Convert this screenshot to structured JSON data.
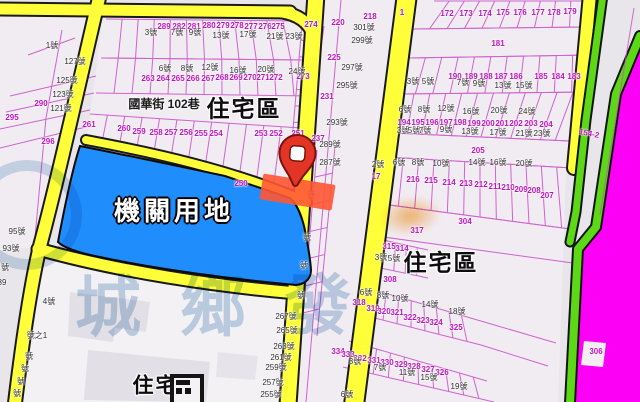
{
  "map": {
    "colors": {
      "road_yellow": "#ffff3a",
      "institution_blue": "#1f8dfc",
      "zone_strip_magenta": "#fb00f4",
      "greenbelt": "#5cd816",
      "selection_highlight": "#ff5634",
      "parcel_line": "#c84cc8",
      "parcel_number": "#c013c0",
      "house_number": "#2e2e2e"
    },
    "zone_labels": [
      {
        "t": "住宅區",
        "x": 244,
        "y": 109,
        "s": 23,
        "st": "k"
      },
      {
        "t": "住宅區",
        "x": 441,
        "y": 263,
        "s": 23,
        "st": "k"
      },
      {
        "t": "住宅區",
        "x": 167,
        "y": 386,
        "s": 21,
        "st": "k"
      },
      {
        "t": "機關用地",
        "x": 174,
        "y": 211,
        "s": 26,
        "st": "w"
      }
    ],
    "street_label": {
      "text": "國華街 102巷",
      "x": 164,
      "y": 104
    },
    "watermark": {
      "chars": [
        {
          "c": "城",
          "x": 108,
          "y": 302
        },
        {
          "c": "鄉",
          "x": 213,
          "y": 302
        },
        {
          "c": "發",
          "x": 318,
          "y": 300
        }
      ]
    },
    "pin": {
      "x": 297,
      "y": 163
    },
    "parcel_numbers": [
      {
        "t": "290",
        "x": 41,
        "y": 104
      },
      {
        "t": "296",
        "x": 48,
        "y": 142
      },
      {
        "t": "295",
        "x": 12,
        "y": 118
      },
      {
        "t": "289",
        "x": 164,
        "y": 27
      },
      {
        "t": "282",
        "x": 179,
        "y": 27
      },
      {
        "t": "281",
        "x": 194,
        "y": 27
      },
      {
        "t": "280",
        "x": 209,
        "y": 26
      },
      {
        "t": "279",
        "x": 223,
        "y": 26
      },
      {
        "t": "278",
        "x": 237,
        "y": 26
      },
      {
        "t": "277",
        "x": 251,
        "y": 27
      },
      {
        "t": "276",
        "x": 265,
        "y": 27
      },
      {
        "t": "275",
        "x": 278,
        "y": 27
      },
      {
        "t": "274",
        "x": 311,
        "y": 25
      },
      {
        "t": "220",
        "x": 338,
        "y": 23
      },
      {
        "t": "218",
        "x": 370,
        "y": 17
      },
      {
        "t": "225",
        "x": 334,
        "y": 58
      },
      {
        "t": "231",
        "x": 327,
        "y": 97
      },
      {
        "t": "237",
        "x": 318,
        "y": 139
      },
      {
        "t": "263",
        "x": 148,
        "y": 79
      },
      {
        "t": "264",
        "x": 163,
        "y": 79
      },
      {
        "t": "265",
        "x": 178,
        "y": 79
      },
      {
        "t": "266",
        "x": 193,
        "y": 79
      },
      {
        "t": "267",
        "x": 208,
        "y": 79
      },
      {
        "t": "268",
        "x": 222,
        "y": 78
      },
      {
        "t": "269",
        "x": 236,
        "y": 78
      },
      {
        "t": "270",
        "x": 250,
        "y": 78
      },
      {
        "t": "271",
        "x": 263,
        "y": 78
      },
      {
        "t": "272",
        "x": 276,
        "y": 78
      },
      {
        "t": "273",
        "x": 303,
        "y": 77
      },
      {
        "t": "261",
        "x": 89,
        "y": 125
      },
      {
        "t": "260",
        "x": 124,
        "y": 129
      },
      {
        "t": "259",
        "x": 139,
        "y": 132
      },
      {
        "t": "258",
        "x": 156,
        "y": 133
      },
      {
        "t": "257",
        "x": 171,
        "y": 133
      },
      {
        "t": "256",
        "x": 186,
        "y": 133
      },
      {
        "t": "255",
        "x": 201,
        "y": 134
      },
      {
        "t": "254",
        "x": 216,
        "y": 134
      },
      {
        "t": "253",
        "x": 261,
        "y": 134
      },
      {
        "t": "252",
        "x": 276,
        "y": 134
      },
      {
        "t": "251",
        "x": 298,
        "y": 134
      },
      {
        "t": "250",
        "x": 241,
        "y": 184
      },
      {
        "t": "1",
        "x": 402,
        "y": 13
      },
      {
        "t": "172",
        "x": 447,
        "y": 14
      },
      {
        "t": "173",
        "x": 466,
        "y": 14
      },
      {
        "t": "174",
        "x": 485,
        "y": 14
      },
      {
        "t": "175",
        "x": 503,
        "y": 13
      },
      {
        "t": "176",
        "x": 520,
        "y": 13
      },
      {
        "t": "177",
        "x": 538,
        "y": 13
      },
      {
        "t": "178",
        "x": 554,
        "y": 13
      },
      {
        "t": "179",
        "x": 570,
        "y": 12
      },
      {
        "t": "181",
        "x": 498,
        "y": 44
      },
      {
        "t": "190",
        "x": 455,
        "y": 77
      },
      {
        "t": "189",
        "x": 471,
        "y": 77
      },
      {
        "t": "188",
        "x": 486,
        "y": 77
      },
      {
        "t": "187",
        "x": 501,
        "y": 77
      },
      {
        "t": "186",
        "x": 516,
        "y": 77
      },
      {
        "t": "185",
        "x": 541,
        "y": 77
      },
      {
        "t": "184",
        "x": 558,
        "y": 77
      },
      {
        "t": "183",
        "x": 574,
        "y": 77
      },
      {
        "t": "194",
        "x": 404,
        "y": 123
      },
      {
        "t": "195",
        "x": 418,
        "y": 123
      },
      {
        "t": "196",
        "x": 432,
        "y": 123
      },
      {
        "t": "197",
        "x": 446,
        "y": 123
      },
      {
        "t": "198",
        "x": 460,
        "y": 123
      },
      {
        "t": "199",
        "x": 474,
        "y": 124
      },
      {
        "t": "200",
        "x": 488,
        "y": 124
      },
      {
        "t": "201",
        "x": 502,
        "y": 124
      },
      {
        "t": "202",
        "x": 516,
        "y": 124
      },
      {
        "t": "203",
        "x": 531,
        "y": 124
      },
      {
        "t": "204",
        "x": 546,
        "y": 125
      },
      {
        "t": "205",
        "x": 478,
        "y": 151
      },
      {
        "t": "17",
        "x": 376,
        "y": 177
      },
      {
        "t": "216",
        "x": 413,
        "y": 180
      },
      {
        "t": "215",
        "x": 431,
        "y": 181
      },
      {
        "t": "214",
        "x": 449,
        "y": 183
      },
      {
        "t": "213",
        "x": 466,
        "y": 184
      },
      {
        "t": "212",
        "x": 481,
        "y": 185
      },
      {
        "t": "211",
        "x": 495,
        "y": 187
      },
      {
        "t": "210",
        "x": 508,
        "y": 188
      },
      {
        "t": "209",
        "x": 521,
        "y": 190
      },
      {
        "t": "208",
        "x": 534,
        "y": 191
      },
      {
        "t": "207",
        "x": 547,
        "y": 196
      },
      {
        "t": "304",
        "x": 465,
        "y": 222
      },
      {
        "t": "317",
        "x": 417,
        "y": 231
      },
      {
        "t": "315",
        "x": 389,
        "y": 247
      },
      {
        "t": "314",
        "x": 402,
        "y": 249
      },
      {
        "t": "308",
        "x": 390,
        "y": 280
      },
      {
        "t": "318",
        "x": 359,
        "y": 303
      },
      {
        "t": "319",
        "x": 373,
        "y": 309
      },
      {
        "t": "320",
        "x": 384,
        "y": 312
      },
      {
        "t": "321",
        "x": 397,
        "y": 313
      },
      {
        "t": "322",
        "x": 410,
        "y": 318
      },
      {
        "t": "323",
        "x": 423,
        "y": 321
      },
      {
        "t": "324",
        "x": 436,
        "y": 323
      },
      {
        "t": "325",
        "x": 456,
        "y": 328
      },
      {
        "t": "334",
        "x": 338,
        "y": 352
      },
      {
        "t": "333",
        "x": 348,
        "y": 355
      },
      {
        "t": "332",
        "x": 360,
        "y": 359
      },
      {
        "t": "331",
        "x": 374,
        "y": 361
      },
      {
        "t": "330",
        "x": 387,
        "y": 363
      },
      {
        "t": "329",
        "x": 401,
        "y": 365
      },
      {
        "t": "328",
        "x": 414,
        "y": 367
      },
      {
        "t": "327",
        "x": 428,
        "y": 370
      },
      {
        "t": "326",
        "x": 442,
        "y": 373
      },
      {
        "t": "154-2",
        "x": 589,
        "y": 134,
        "r": 12
      },
      {
        "t": "306",
        "x": 596,
        "y": 352
      }
    ],
    "house_numbers": [
      {
        "t": "1號",
        "x": 52,
        "y": 46
      },
      {
        "t": "127號",
        "x": 75,
        "y": 62
      },
      {
        "t": "125號",
        "x": 67,
        "y": 81
      },
      {
        "t": "123號",
        "x": 63,
        "y": 95
      },
      {
        "t": "121號",
        "x": 61,
        "y": 109
      },
      {
        "t": "95號",
        "x": 17,
        "y": 232
      },
      {
        "t": "93號",
        "x": 11,
        "y": 249
      },
      {
        "t": "號",
        "x": 5,
        "y": 268
      },
      {
        "t": "89",
        "x": 2,
        "y": 283
      },
      {
        "t": "4號",
        "x": 49,
        "y": 302
      },
      {
        "t": "號之1",
        "x": 37,
        "y": 336
      },
      {
        "t": "號",
        "x": 29,
        "y": 357
      },
      {
        "t": "號",
        "x": 25,
        "y": 369
      },
      {
        "t": "號",
        "x": 21,
        "y": 382
      },
      {
        "t": "號",
        "x": 17,
        "y": 394
      },
      {
        "t": "3號",
        "x": 151,
        "y": 33
      },
      {
        "t": "7號",
        "x": 177,
        "y": 33
      },
      {
        "t": "9號",
        "x": 195,
        "y": 33
      },
      {
        "t": "13號",
        "x": 221,
        "y": 36
      },
      {
        "t": "17號",
        "x": 248,
        "y": 35
      },
      {
        "t": "21號",
        "x": 275,
        "y": 37
      },
      {
        "t": "23號",
        "x": 294,
        "y": 37
      },
      {
        "t": "6號",
        "x": 165,
        "y": 69
      },
      {
        "t": "8號",
        "x": 187,
        "y": 69
      },
      {
        "t": "12號",
        "x": 210,
        "y": 68
      },
      {
        "t": "16號",
        "x": 238,
        "y": 71
      },
      {
        "t": "20號",
        "x": 266,
        "y": 70
      },
      {
        "t": "24號",
        "x": 297,
        "y": 72
      },
      {
        "t": "301號",
        "x": 364,
        "y": 28
      },
      {
        "t": "299號",
        "x": 362,
        "y": 41
      },
      {
        "t": "297號",
        "x": 352,
        "y": 68
      },
      {
        "t": "295號",
        "x": 347,
        "y": 86
      },
      {
        "t": "293號",
        "x": 337,
        "y": 123
      },
      {
        "t": "289號",
        "x": 330,
        "y": 145
      },
      {
        "t": "287號",
        "x": 330,
        "y": 163
      },
      {
        "t": "號",
        "x": 311,
        "y": 196
      },
      {
        "t": "號",
        "x": 307,
        "y": 238
      },
      {
        "t": "號",
        "x": 304,
        "y": 266
      },
      {
        "t": "號",
        "x": 301,
        "y": 296
      },
      {
        "t": "3號",
        "x": 413,
        "y": 82
      },
      {
        "t": "5號",
        "x": 428,
        "y": 82
      },
      {
        "t": "7號",
        "x": 463,
        "y": 83
      },
      {
        "t": "9號",
        "x": 479,
        "y": 84
      },
      {
        "t": "13號",
        "x": 503,
        "y": 86
      },
      {
        "t": "15號",
        "x": 524,
        "y": 86
      },
      {
        "t": "6號",
        "x": 405,
        "y": 110
      },
      {
        "t": "8號",
        "x": 424,
        "y": 110
      },
      {
        "t": "12號",
        "x": 446,
        "y": 109
      },
      {
        "t": "16號",
        "x": 471,
        "y": 112
      },
      {
        "t": "20號",
        "x": 499,
        "y": 111
      },
      {
        "t": "24號",
        "x": 527,
        "y": 112
      },
      {
        "t": "3號",
        "x": 403,
        "y": 131
      },
      {
        "t": "5號",
        "x": 414,
        "y": 131
      },
      {
        "t": "7號",
        "x": 425,
        "y": 131
      },
      {
        "t": "9號",
        "x": 446,
        "y": 130
      },
      {
        "t": "13號",
        "x": 470,
        "y": 132
      },
      {
        "t": "17號",
        "x": 498,
        "y": 133
      },
      {
        "t": "21號",
        "x": 524,
        "y": 134
      },
      {
        "t": "23號",
        "x": 542,
        "y": 134
      },
      {
        "t": "2號",
        "x": 378,
        "y": 165
      },
      {
        "t": "6號",
        "x": 399,
        "y": 163
      },
      {
        "t": "8號",
        "x": 418,
        "y": 163
      },
      {
        "t": "10號",
        "x": 441,
        "y": 164
      },
      {
        "t": "14號",
        "x": 477,
        "y": 163
      },
      {
        "t": "16號",
        "x": 498,
        "y": 163
      },
      {
        "t": "20號",
        "x": 524,
        "y": 164
      },
      {
        "t": "3號",
        "x": 381,
        "y": 258
      },
      {
        "t": "5號",
        "x": 394,
        "y": 259
      },
      {
        "t": "6號",
        "x": 366,
        "y": 293
      },
      {
        "t": "8號",
        "x": 383,
        "y": 296
      },
      {
        "t": "10號",
        "x": 400,
        "y": 299
      },
      {
        "t": "14號",
        "x": 430,
        "y": 305
      },
      {
        "t": "18號",
        "x": 457,
        "y": 312
      },
      {
        "t": "3號",
        "x": 355,
        "y": 362
      },
      {
        "t": "7號",
        "x": 380,
        "y": 368
      },
      {
        "t": "11號",
        "x": 407,
        "y": 373
      },
      {
        "t": "15號",
        "x": 429,
        "y": 378
      },
      {
        "t": "19號",
        "x": 459,
        "y": 387
      },
      {
        "t": "6號",
        "x": 347,
        "y": 395
      },
      {
        "t": "267號",
        "x": 286,
        "y": 317
      },
      {
        "t": "265號",
        "x": 287,
        "y": 331
      },
      {
        "t": "263號",
        "x": 284,
        "y": 347
      },
      {
        "t": "261號",
        "x": 281,
        "y": 358
      },
      {
        "t": "259號",
        "x": 276,
        "y": 368
      },
      {
        "t": "257號",
        "x": 273,
        "y": 383
      },
      {
        "t": "255號",
        "x": 271,
        "y": 395
      }
    ]
  }
}
